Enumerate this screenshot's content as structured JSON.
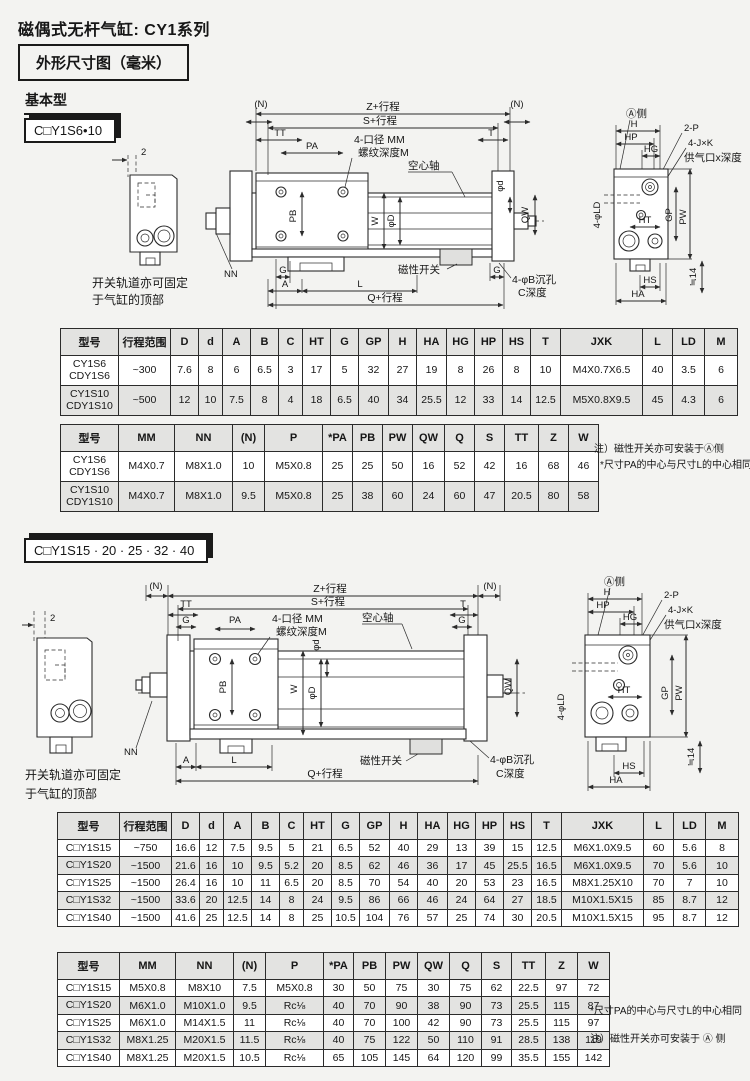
{
  "page": {
    "title": "磁偶式无杆气缸: CY1系列",
    "subtitle": "外形尺寸图（毫米）"
  },
  "sections": {
    "basic": {
      "heading": "基本型",
      "model": "C□Y1S6•10"
    },
    "large": {
      "model": "C□Y1S15 · 20 · 25 · 32 · 40"
    }
  },
  "dl": {
    "dim2": "2",
    "cap1": "开关轨道亦可固定",
    "cap2": "于气缸的顶部",
    "n": "(N)",
    "z": "Z+行程",
    "s": "S+行程",
    "tt": "TT",
    "t": "T",
    "g": "G",
    "pa": "PA",
    "bore": "4-口径 MM",
    "thread": "螺纹深度M",
    "hollow": "空心轴",
    "pb": "PB",
    "w": "W",
    "phid": "φd",
    "phiD": "φD",
    "qw": "QW",
    "nn": "NN",
    "a": "A",
    "l": "L",
    "q": "Q+行程",
    "mag": "磁性开关",
    "cbore": "4-φB沉孔",
    "cdepth": "C深度",
    "aside": "Ⓐ侧",
    "h": "H",
    "hp": "HP",
    "hg": "HG",
    "p2": "2-P",
    "jxk": "4-J×K",
    "port": "供气口x深度",
    "ld": "4-φLD",
    "ht": "HT",
    "gp": "GP",
    "pw": "PW",
    "hs": "HS",
    "ha": "HA",
    "approx": "≒14"
  },
  "tables": {
    "t1": {
      "headers": [
        "型号",
        "行程范围",
        "D",
        "d",
        "A",
        "B",
        "C",
        "HT",
        "G",
        "GP",
        "H",
        "HA",
        "HG",
        "HP",
        "HS",
        "T",
        "JXK",
        "L",
        "LD",
        "M"
      ],
      "widths": [
        58,
        52,
        28,
        24,
        28,
        28,
        24,
        28,
        28,
        30,
        28,
        30,
        28,
        28,
        28,
        30,
        82,
        30,
        32,
        33
      ],
      "rows": [
        [
          "CY1S6\nCDY1S6",
          "~300",
          "7.6",
          "8",
          "6",
          "6.5",
          "3",
          "17",
          "5",
          "32",
          "27",
          "19",
          "8",
          "26",
          "8",
          "10",
          "M4X0.7X6.5",
          "40",
          "3.5",
          "6"
        ],
        [
          "CY1S10\nCDY1S10",
          "~500",
          "12",
          "10",
          "7.5",
          "8",
          "4",
          "18",
          "6.5",
          "40",
          "34",
          "25.5",
          "12",
          "33",
          "14",
          "12.5",
          "M5X0.8X9.5",
          "45",
          "4.3",
          "6"
        ]
      ]
    },
    "t2": {
      "headers": [
        "型号",
        "MM",
        "NN",
        "(N)",
        "P",
        "*PA",
        "PB",
        "PW",
        "QW",
        "Q",
        "S",
        "TT",
        "Z",
        "W"
      ],
      "widths": [
        58,
        56,
        58,
        32,
        58,
        30,
        30,
        30,
        32,
        30,
        30,
        34,
        30,
        30
      ],
      "rows": [
        [
          "CY1S6\nCDY1S6",
          "M4X0.7",
          "M8X1.0",
          "10",
          "M5X0.8",
          "25",
          "25",
          "50",
          "16",
          "52",
          "42",
          "16",
          "68",
          "46"
        ],
        [
          "CY1S10\nCDY1S10",
          "M4X0.7",
          "M8X1.0",
          "9.5",
          "M5X0.8",
          "25",
          "38",
          "60",
          "24",
          "60",
          "47",
          "20.5",
          "80",
          "58"
        ]
      ]
    },
    "t3": {
      "headers": [
        "型号",
        "行程范围",
        "D",
        "d",
        "A",
        "B",
        "C",
        "HT",
        "G",
        "GP",
        "H",
        "HA",
        "HG",
        "HP",
        "HS",
        "T",
        "JXK",
        "L",
        "LD",
        "M"
      ],
      "widths": [
        62,
        52,
        28,
        24,
        28,
        28,
        24,
        28,
        28,
        30,
        28,
        30,
        28,
        28,
        28,
        30,
        82,
        30,
        32,
        33
      ],
      "rows": [
        [
          "C□Y1S15",
          "~750",
          "16.6",
          "12",
          "7.5",
          "9.5",
          "5",
          "21",
          "6.5",
          "52",
          "40",
          "29",
          "13",
          "39",
          "15",
          "12.5",
          "M6X1.0X9.5",
          "60",
          "5.6",
          "8"
        ],
        [
          "C□Y1S20",
          "~1500",
          "21.6",
          "16",
          "10",
          "9.5",
          "5.2",
          "20",
          "8.5",
          "62",
          "46",
          "36",
          "17",
          "45",
          "25.5",
          "16.5",
          "M6X1.0X9.5",
          "70",
          "5.6",
          "10"
        ],
        [
          "C□Y1S25",
          "~1500",
          "26.4",
          "16",
          "10",
          "11",
          "6.5",
          "20",
          "8.5",
          "70",
          "54",
          "40",
          "20",
          "53",
          "23",
          "16.5",
          "M8X1.25X10",
          "70",
          "7",
          "10"
        ],
        [
          "C□Y1S32",
          "~1500",
          "33.6",
          "20",
          "12.5",
          "14",
          "8",
          "24",
          "9.5",
          "86",
          "66",
          "46",
          "24",
          "64",
          "27",
          "18.5",
          "M10X1.5X15",
          "85",
          "8.7",
          "12"
        ],
        [
          "C□Y1S40",
          "~1500",
          "41.6",
          "25",
          "12.5",
          "14",
          "8",
          "25",
          "10.5",
          "104",
          "76",
          "57",
          "25",
          "74",
          "30",
          "20.5",
          "M10X1.5X15",
          "95",
          "8.7",
          "12"
        ]
      ]
    },
    "t4": {
      "headers": [
        "型号",
        "MM",
        "NN",
        "(N)",
        "P",
        "*PA",
        "PB",
        "PW",
        "QW",
        "Q",
        "S",
        "TT",
        "Z",
        "W"
      ],
      "widths": [
        62,
        56,
        58,
        32,
        58,
        30,
        32,
        32,
        32,
        32,
        30,
        34,
        32,
        32
      ],
      "rows": [
        [
          "C□Y1S15",
          "M5X0.8",
          "M8X10",
          "7.5",
          "M5X0.8",
          "30",
          "50",
          "75",
          "30",
          "75",
          "62",
          "22.5",
          "97",
          "72"
        ],
        [
          "C□Y1S20",
          "M6X1.0",
          "M10X1.0",
          "9.5",
          "Rc⅛",
          "40",
          "70",
          "90",
          "38",
          "90",
          "73",
          "25.5",
          "115",
          "87"
        ],
        [
          "C□Y1S25",
          "M6X1.0",
          "M14X1.5",
          "11",
          "Rc⅛",
          "40",
          "70",
          "100",
          "42",
          "90",
          "73",
          "25.5",
          "115",
          "97"
        ],
        [
          "C□Y1S32",
          "M8X1.25",
          "M20X1.5",
          "11.5",
          "Rc⅛",
          "40",
          "75",
          "122",
          "50",
          "110",
          "91",
          "28.5",
          "138",
          "119"
        ],
        [
          "C□Y1S40",
          "M8X1.25",
          "M20X1.5",
          "10.5",
          "Rc⅛",
          "65",
          "105",
          "145",
          "64",
          "120",
          "99",
          "35.5",
          "155",
          "142"
        ]
      ]
    }
  },
  "notes1": {
    "line1": "注）磁性开关亦可安装于Ⓐ侧",
    "line2": "*尺寸PA的中心与尺寸L的中心相同"
  },
  "notes2": {
    "line1": "*尺寸PA的中心与尺寸L的中心相同",
    "line2": "注）磁性开关亦可安装于 Ⓐ 侧"
  }
}
